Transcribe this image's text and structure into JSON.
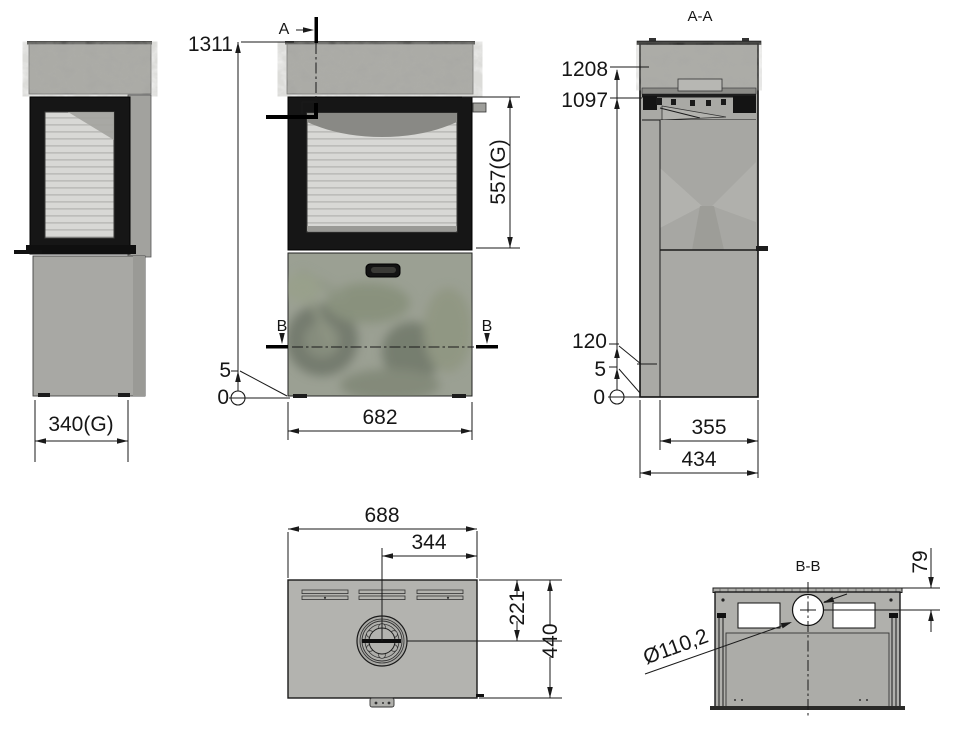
{
  "labels": {
    "section_a": "A",
    "section_b": "B"
  },
  "views": {
    "side_view": {
      "glass_width": "340(G)"
    },
    "front_view": {
      "total_height": "1311",
      "glass_height": "557(G)",
      "width": "682",
      "base_gap": "5",
      "datum_zero": "0"
    },
    "section_aa": {
      "title": "A-A",
      "top_edge_height": "1208",
      "convection_height": "1097",
      "panel_bottom_height": "120",
      "base_gap": "5",
      "datum_zero": "0",
      "inner_depth": "355",
      "total_depth": "434"
    },
    "top_view": {
      "total_width": "688",
      "flue_center_from_right": "344",
      "flue_center_from_front": "221",
      "total_depth": "440"
    },
    "section_bb": {
      "title": "B-B",
      "flue_diameter": "Ø110,2",
      "flue_center_offset": "79"
    }
  },
  "colors": {
    "line": "#1a1a1a",
    "body_gray": "#b0b0ac",
    "panel_gray": "#a6a6a2",
    "frame_black": "#141414",
    "glass_light": "#d8d8d5",
    "background": "#ffffff"
  }
}
